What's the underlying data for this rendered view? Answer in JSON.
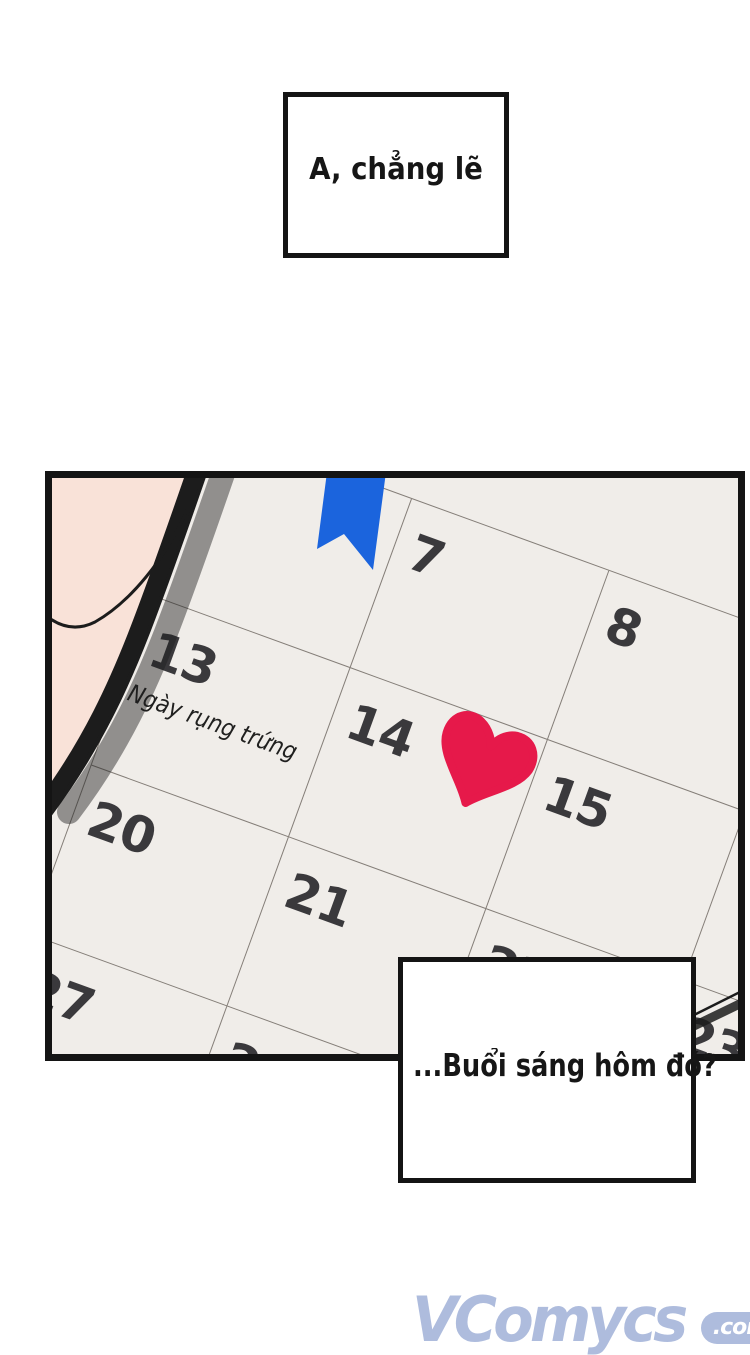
{
  "speech_top": {
    "text": "A, chẳng lẽ"
  },
  "speech_bottom": {
    "text": "...Buổi sáng hôm đó?"
  },
  "calendar": {
    "rotation_deg": 20,
    "note": "Ngày rụng trứng",
    "rows": [
      [
        "",
        "7",
        "8",
        ""
      ],
      [
        "13",
        "14",
        "15",
        ""
      ],
      [
        "20",
        "21",
        "22",
        "23"
      ],
      [
        "27",
        "28",
        "",
        ""
      ]
    ],
    "heart_on_day": "14",
    "ribbon_over_day_column": "6"
  },
  "colors": {
    "paper": "#f0ede9",
    "grid_line": "#847e78",
    "number": "#3a393c",
    "heart": "#e6194a",
    "ribbon": "#1b64dd",
    "skin": "#f9e2d8",
    "skin_shade": "#f1b0a0",
    "shadow": "#bcb4ae",
    "panel_border": "#141414",
    "watermark": "#a8b7db"
  },
  "watermark": {
    "name": "VComycs",
    "tld": ".com"
  }
}
